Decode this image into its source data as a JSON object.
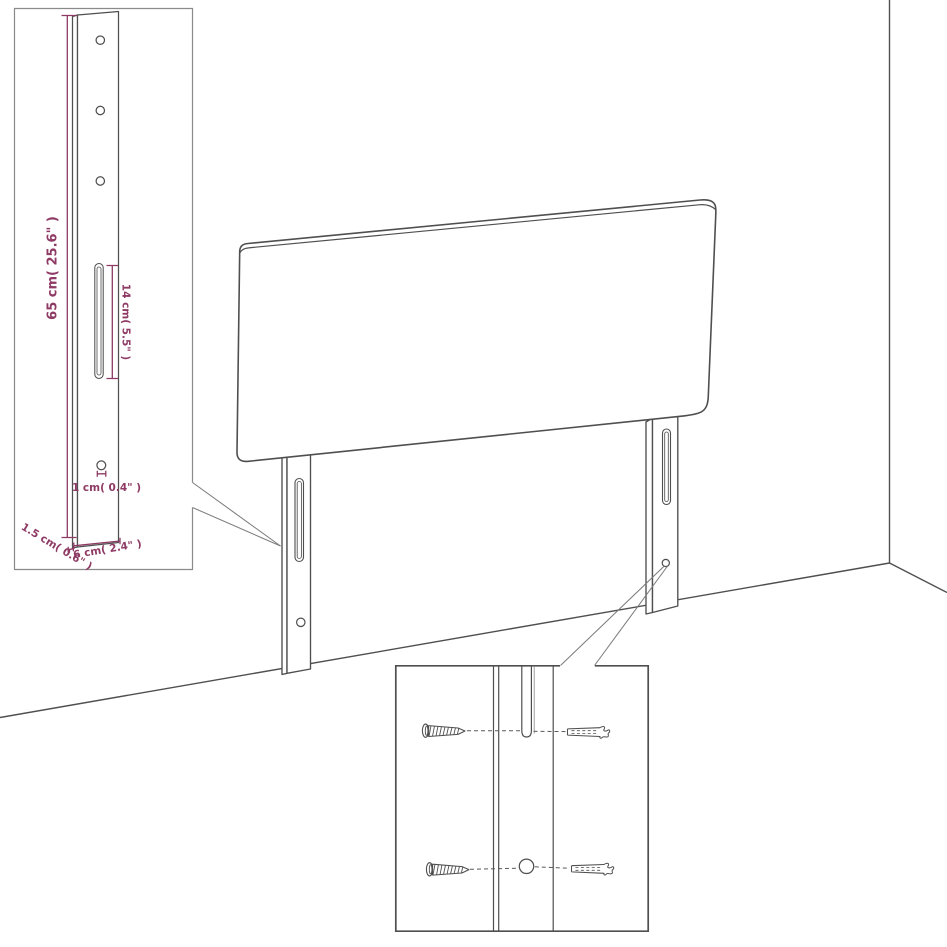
{
  "diagram": {
    "accent_color": "#8e3a64",
    "line_color": "#4f4f4f",
    "dimensions": {
      "height": "65 cm( 25.6\" )",
      "slot_length": "14 cm( 5.5\" )",
      "hole_diameter": "1 cm( 0.4\" )",
      "side_thickness": "1.5 cm( 0.6\" )",
      "leg_width": "6 cm( 2.4\" )"
    }
  }
}
